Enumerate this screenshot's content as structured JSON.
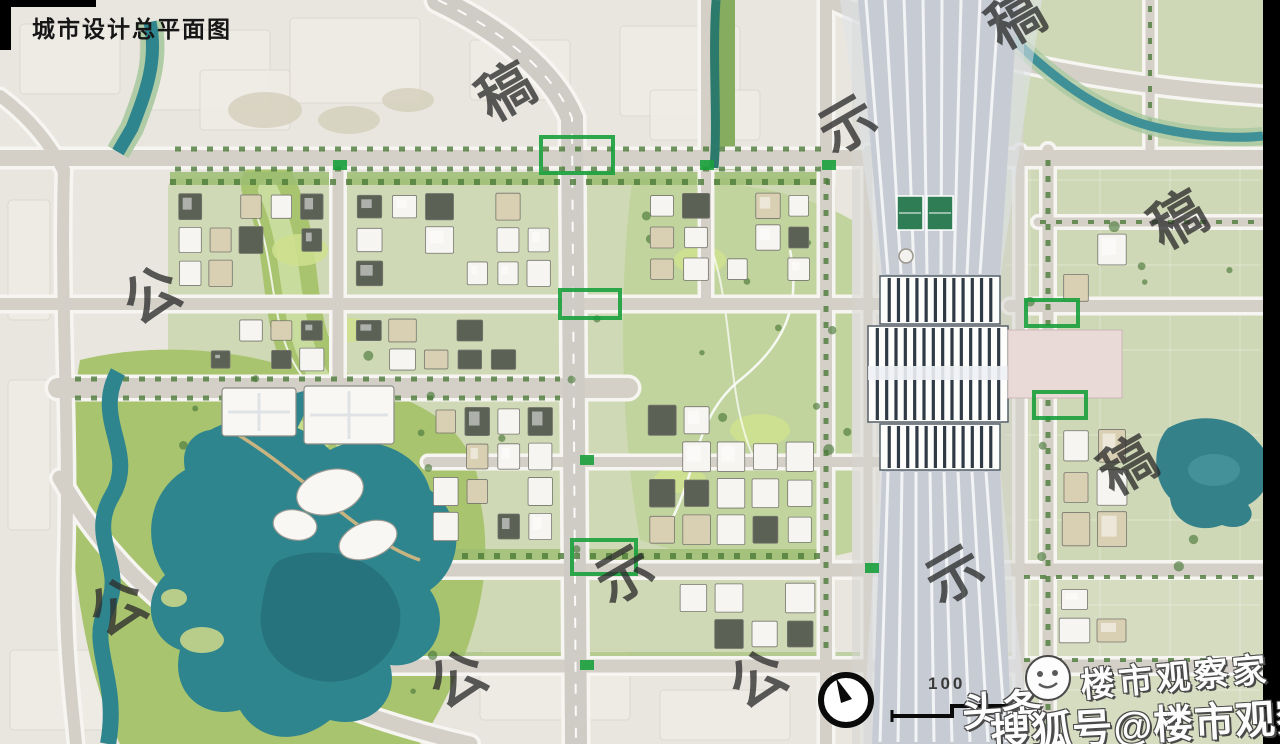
{
  "title": "城市设计总平面图",
  "watermark": {
    "phrase": "公示稿",
    "chars": [
      {
        "text": "稿"
      },
      {
        "text": "示"
      },
      {
        "text": "稿"
      },
      {
        "text": "公"
      },
      {
        "text": "稿"
      },
      {
        "text": "稿"
      },
      {
        "text": "公"
      },
      {
        "text": "示"
      },
      {
        "text": "示"
      },
      {
        "text": "公"
      },
      {
        "text": "公"
      }
    ]
  },
  "branding": {
    "toutiao": "头条",
    "observer": "楼市观察家",
    "sohu": "搜狐号@楼市观察家"
  },
  "scale_bar": {
    "label": "100"
  },
  "map": {
    "colors": {
      "water": "#2f858d",
      "water_deep": "#25707a",
      "park": "#a9c46f",
      "park_light": "#c2d49e",
      "meadow": "#cfe08e",
      "tree": "#4c7a3a",
      "rural": "#cfd8b6",
      "road": "#d4d0c8",
      "road_casing": "#f7f5f1",
      "building_white": "#f6f5f1",
      "building_dark": "#5c6156",
      "building_tan": "#d9cfb2",
      "station_rib": "#2f3a45",
      "track_fan": "#c7ccd4",
      "plaza_pink": "#e9d9d7",
      "accent_green": "#18a03c"
    }
  }
}
